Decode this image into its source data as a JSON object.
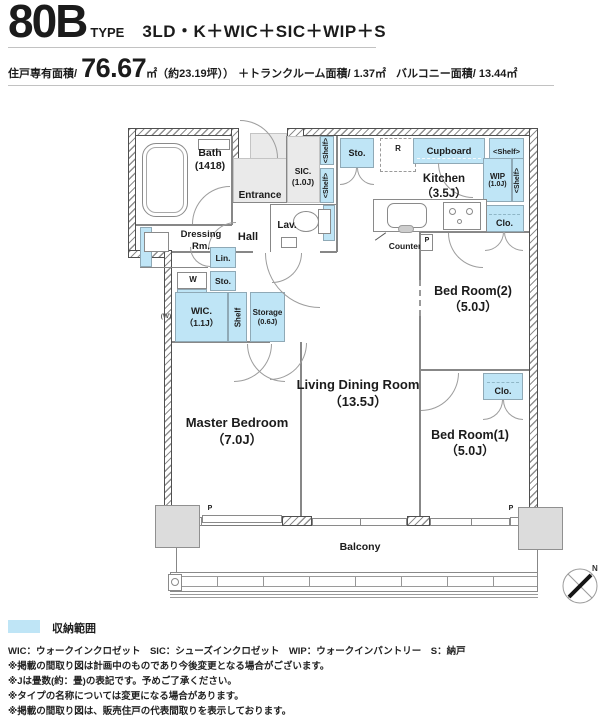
{
  "header": {
    "type_number": "80B",
    "type_word": "TYPE",
    "layout": "3LD・K＋WIC＋SIC＋WIP＋S",
    "area_label": "住戸専有面積/",
    "area_value": "76.67",
    "area_unit": "㎡",
    "area_note": "（約23.19坪））",
    "trunk_label": "＋トランクルーム面積/",
    "trunk_value": "1.37㎡",
    "balcony_label": "バルコニー面積/",
    "balcony_value": "13.44㎡"
  },
  "plan": {
    "rooms": {
      "bath": {
        "name": "Bath",
        "size": "(1418)"
      },
      "entrance": {
        "name": "Entrance"
      },
      "sic": {
        "name": "SIC.",
        "size": "(1.0J)"
      },
      "dressing": {
        "line1": "Dressing",
        "line2": "Rm."
      },
      "hall": {
        "name": "Hall"
      },
      "lav": {
        "name": "Lav."
      },
      "kitchen": {
        "name": "Kitchen",
        "size": "（3.5J）"
      },
      "wic": {
        "name": "WIC.",
        "size": "（1.1J）"
      },
      "storage": {
        "name": "Storage",
        "size": "(0.6J)"
      },
      "master": {
        "name": "Master Bedroom",
        "size": "（7.0J）"
      },
      "living": {
        "name": "Living Dining Room",
        "size": "（13.5J）"
      },
      "bed2": {
        "name": "Bed Room(2)",
        "size": "（5.0J）"
      },
      "bed1": {
        "name": "Bed Room(1)",
        "size": "（5.0J）"
      },
      "balcony": {
        "name": "Balcony"
      }
    },
    "fixtures": {
      "shelf_vertical": "<Shelf>",
      "shelf_horizontal": "<Shelf>",
      "shelf_plain": "Shelf",
      "sto": "Sto.",
      "lin": "Lin.",
      "clo": "Clo.",
      "cupboard": "Cupboard",
      "wip_name": "WIP",
      "wip_size": "(1.0J)",
      "refrigerator": "R",
      "washer": "W",
      "washer_paren": "(W)",
      "counter": "Counter",
      "pipe": "P",
      "north": "N"
    }
  },
  "legend": {
    "label": "収納範囲",
    "storage_color": "#bfe5f6"
  },
  "footer": {
    "abbreviations": "WIC：ウォークインクロゼット　SIC：シューズインクロゼット　WIP：ウォークインパントリー　S：納戸",
    "notes": [
      "※掲載の間取り図は計画中のものであり今後変更となる場合がございます。",
      "※Jは畳数(約：畳)の表記です。予めご了承ください。",
      "※タイプの名称については変更になる場合があります。",
      "※掲載の間取り図は、販売住戸の代表間取りを表示しております。"
    ]
  }
}
